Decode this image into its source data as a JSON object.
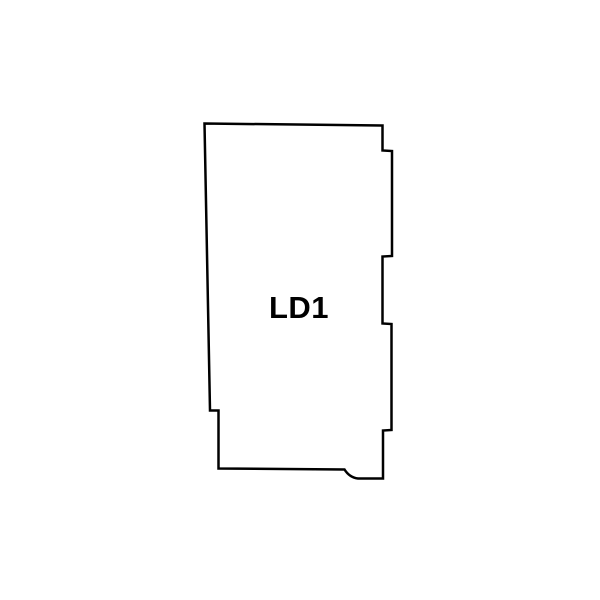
{
  "page": {
    "background_color": "#ffffff"
  },
  "diagram": {
    "label": "LD1",
    "outline_color": "#000000",
    "fill_color": "#ffffff",
    "label_color": "#000000"
  }
}
